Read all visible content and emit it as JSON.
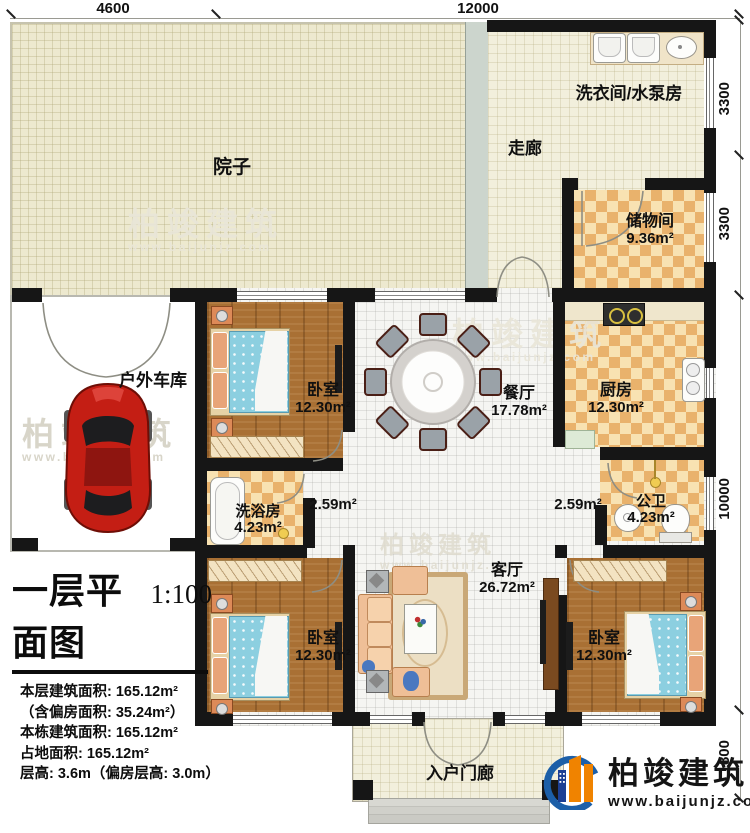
{
  "plan": {
    "title": "一层平面图",
    "scale": "1:100",
    "info_lines": [
      "本层建筑面积: 165.12m²",
      "（含偏房面积: 35.24m²）",
      "本栋建筑面积: 165.12m²",
      "占地面积: 165.12m²",
      "层高: 3.6m（偏房层高: 3.0m）"
    ]
  },
  "dimensions": {
    "top": [
      "4600",
      "12000"
    ],
    "right": [
      "3300",
      "3300",
      "10000",
      "1800"
    ]
  },
  "rooms": {
    "yard": {
      "name": "院子"
    },
    "corridor": {
      "name": "走廊"
    },
    "laundry": {
      "name": "洗衣间/水泵房"
    },
    "storage": {
      "name": "储物间",
      "area": "9.36m²"
    },
    "garage": {
      "name": "户外车库"
    },
    "bedroom1": {
      "name": "卧室",
      "area": "12.30m²"
    },
    "dining": {
      "name": "餐厅",
      "area": "17.78m²"
    },
    "kitchen": {
      "name": "厨房",
      "area": "12.30m²"
    },
    "bath": {
      "name": "洗浴房",
      "area": "4.23m²"
    },
    "hall_left": {
      "area": "2.59m²"
    },
    "hall_right": {
      "area": "2.59m²"
    },
    "wc": {
      "name": "公卫",
      "area": "4.23m²"
    },
    "living": {
      "name": "客厅",
      "area": "26.72m²"
    },
    "bedroom2": {
      "name": "卧室",
      "area": "12.30m²"
    },
    "bedroom3": {
      "name": "卧室",
      "area": "12.30m²"
    },
    "porch": {
      "name": "入户门廊"
    }
  },
  "branding": {
    "logo_text": "柏竣建筑",
    "logo_url": "www.baijunjz.com",
    "watermark_text": "柏竣建筑",
    "watermark_url": "www.baijunjz.com"
  },
  "colors": {
    "wall": "#161616",
    "checker_dark": "#e9b26c",
    "checker_light": "#f8e2b2",
    "wood": "#a97034",
    "bed_blue": "#8ccfe0",
    "car_red": "#c41e14",
    "logo_orange": "#f08300",
    "logo_blue": "#1c5fa8"
  }
}
